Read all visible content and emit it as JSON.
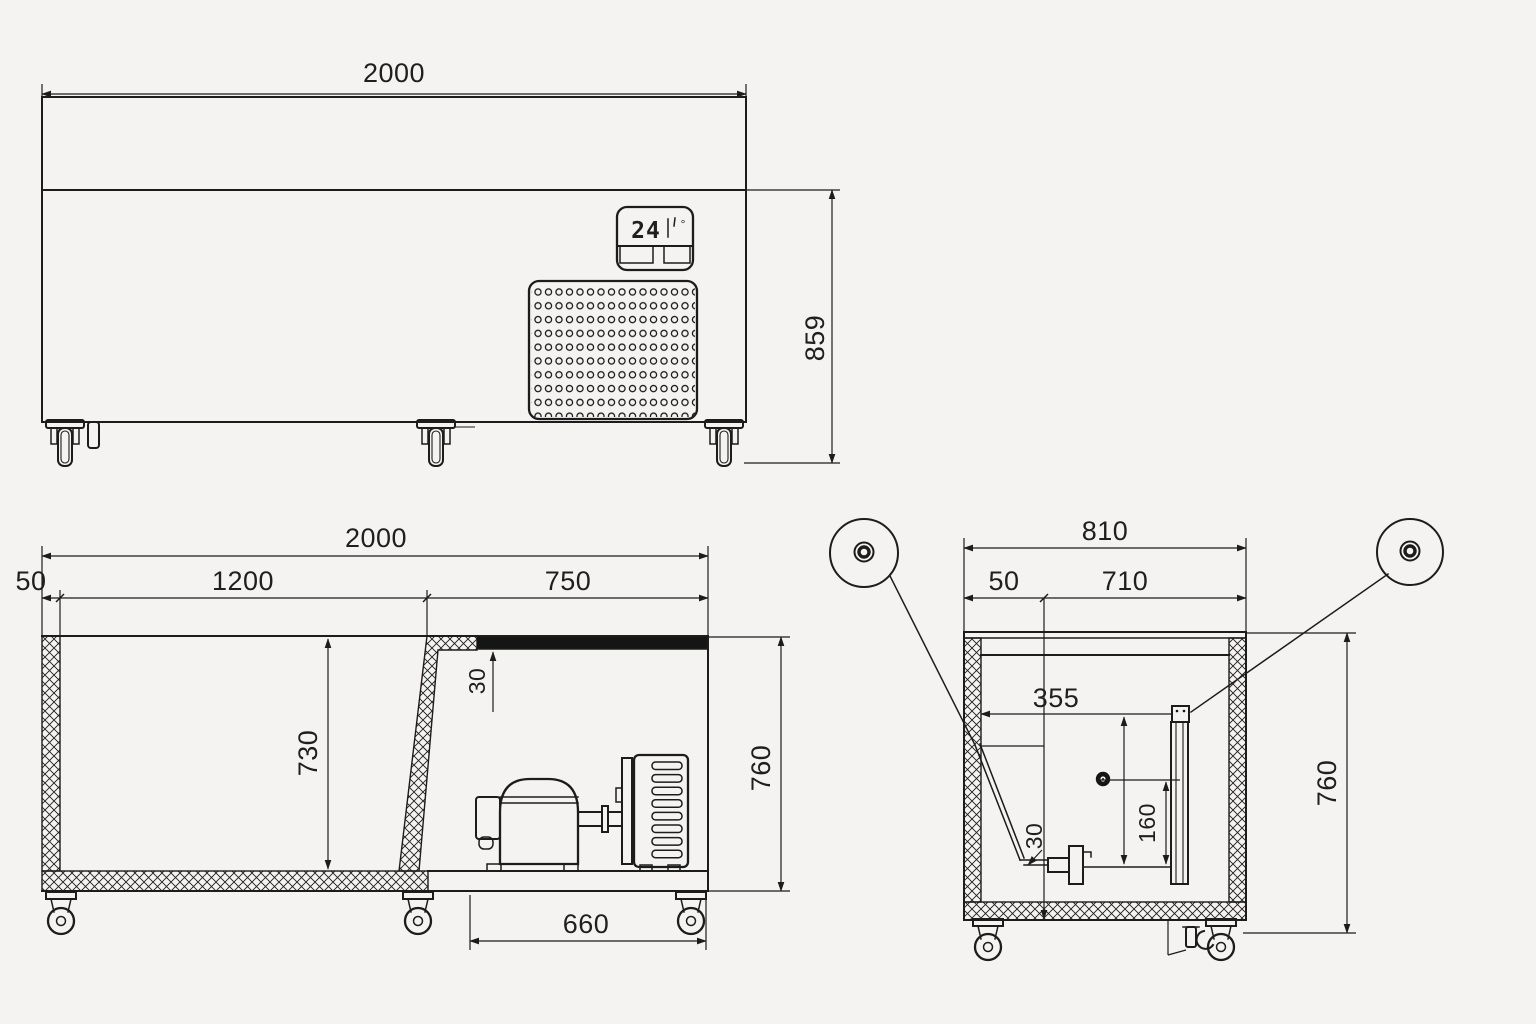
{
  "style": {
    "background": "#f4f3f1",
    "ink": "#1c1c1c",
    "solid_fill": "#151515"
  },
  "front_view": {
    "dim_width": "2000",
    "dim_height": "859",
    "display_value": "24",
    "display_degree": "°"
  },
  "side_section": {
    "dim_overall_width": "2000",
    "dim_wall": "50",
    "dim_chamber": "1200",
    "dim_bay": "750",
    "dim_worktop": "30",
    "dim_depth": "730",
    "dim_height": "760",
    "dim_bay_floor": "660"
  },
  "end_section": {
    "dim_overall_width": "810",
    "dim_wall": "50",
    "dim_inner_width": "710",
    "dim_drain_offset": "355",
    "dim_pipe": "30",
    "dim_riser": "160",
    "dim_height": "760"
  }
}
